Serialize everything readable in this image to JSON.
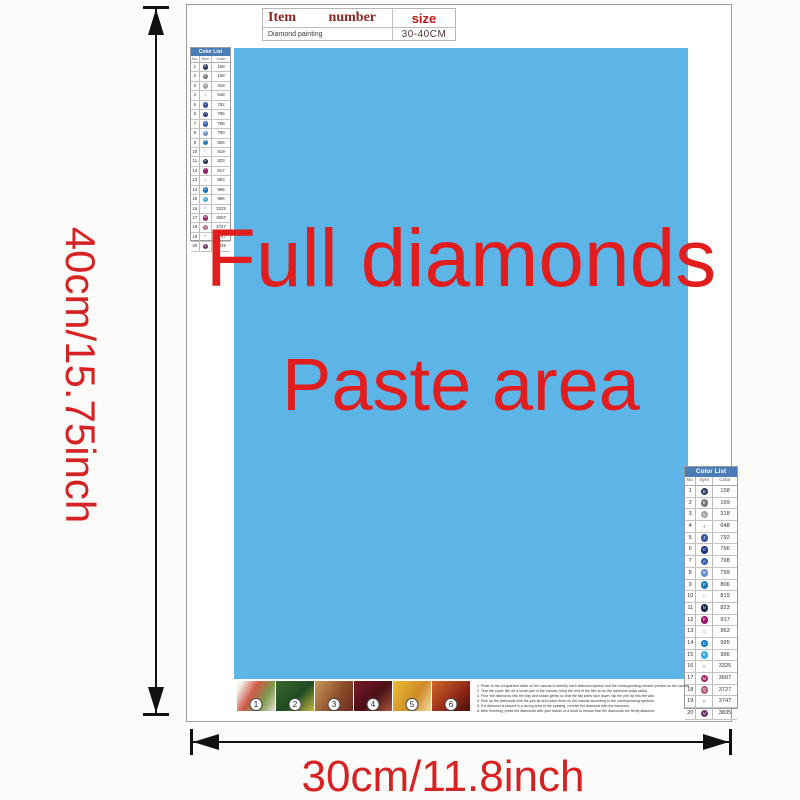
{
  "product_table": {
    "item_label": "Item",
    "number_label": "number",
    "size_label": "size",
    "item_value": "Diamond painting",
    "size_value": "30-40CM"
  },
  "paste_area": {
    "line1": "Full diamonds",
    "line2": "Paste area",
    "bg_color": "#5db4e7",
    "text_color": "#e11d1d"
  },
  "dimensions": {
    "height_label": "40cm/15.75inch",
    "width_label": "30cm/11.8inch"
  },
  "color_list": {
    "title": "Color List",
    "col_no": "No.",
    "col_sym": "Sym",
    "col_color": "Color",
    "header_bg": "#4a7cb8",
    "rows": [
      {
        "no": "1",
        "sym": "B",
        "color": "158",
        "bg": "#2e3560",
        "fg": "#ffffff"
      },
      {
        "no": "2",
        "sym": "E",
        "color": "169",
        "bg": "#75757f",
        "fg": "#ffffff"
      },
      {
        "no": "3",
        "sym": "G",
        "color": "318",
        "bg": "#9fa0a8",
        "fg": "#ffffff"
      },
      {
        "no": "4",
        "sym": "4",
        "color": "648",
        "bg": "none",
        "fg": "#8a857c"
      },
      {
        "no": "5",
        "sym": "J",
        "color": "792",
        "bg": "#3a4f9e",
        "fg": "#ffffff"
      },
      {
        "no": "6",
        "sym": "O",
        "color": "796",
        "bg": "#1b2f80",
        "fg": "#ffffff"
      },
      {
        "no": "7",
        "sym": "A",
        "color": "798",
        "bg": "#2f5cae",
        "fg": "#ffffff"
      },
      {
        "no": "8",
        "sym": "9",
        "color": "799",
        "bg": "#6a8cd0",
        "fg": "#ffffff"
      },
      {
        "no": "9",
        "sym": "P",
        "color": "806",
        "bg": "#1879b2",
        "fg": "#ffffff"
      },
      {
        "no": "10",
        "sym": "C",
        "color": "819",
        "bg": "none",
        "fg": "#c9a0a8"
      },
      {
        "no": "11",
        "sym": "N",
        "color": "823",
        "bg": "#192248",
        "fg": "#ffffff"
      },
      {
        "no": "12",
        "sym": "F",
        "color": "917",
        "bg": "#9c1870",
        "fg": "#ffffff"
      },
      {
        "no": "13",
        "sym": "Q",
        "color": "963",
        "bg": "none",
        "fg": "#d898a8"
      },
      {
        "no": "14",
        "sym": "D",
        "color": "995",
        "bg": "#0d74c4",
        "fg": "#ffffff"
      },
      {
        "no": "15",
        "sym": "K",
        "color": "996",
        "bg": "#38a8dc",
        "fg": "#ffffff"
      },
      {
        "no": "16",
        "sym": "R",
        "color": "3325",
        "bg": "none",
        "fg": "#88a8cc"
      },
      {
        "no": "17",
        "sym": "M",
        "color": "3607",
        "bg": "#a02464",
        "fg": "#ffffff"
      },
      {
        "no": "18",
        "sym": "Q",
        "color": "3727",
        "bg": "#b05878",
        "fg": "#ffffff"
      },
      {
        "no": "19",
        "sym": "R",
        "color": "3747",
        "bg": "none",
        "fg": "#9494c4"
      },
      {
        "no": "20",
        "sym": "V",
        "color": "3835",
        "bg": "#6b3462",
        "fg": "#ffffff"
      }
    ]
  },
  "steps": [
    {
      "num": "1"
    },
    {
      "num": "2"
    },
    {
      "num": "3"
    },
    {
      "num": "4"
    },
    {
      "num": "5"
    },
    {
      "num": "6"
    }
  ],
  "instructions": [
    {
      "text": "1. Refer to the comparison table on the canvas to identify each diamond symbol and the corresponding number printed on the canvas."
    },
    {
      "text": "2. Tear the cover film off a small part of the canvas; keep the rest of the film on so the adhesive stays sticky."
    },
    {
      "text": "3. Pour the diamonds into the tray and shake gently so that the flat sides face down; dip the pen tip into the wax."
    },
    {
      "text": "4. Pick up the diamonds with the pen tip and place them on the canvas according to the corresponding symbols."
    },
    {
      "text": "5. If a diamond is placed in a wrong area of the painting, remove the diamond with the tweezers."
    },
    {
      "text": "6. After finishing, press the diamonds with your hands or a book to ensure that the diamonds are firmly attached."
    }
  ]
}
